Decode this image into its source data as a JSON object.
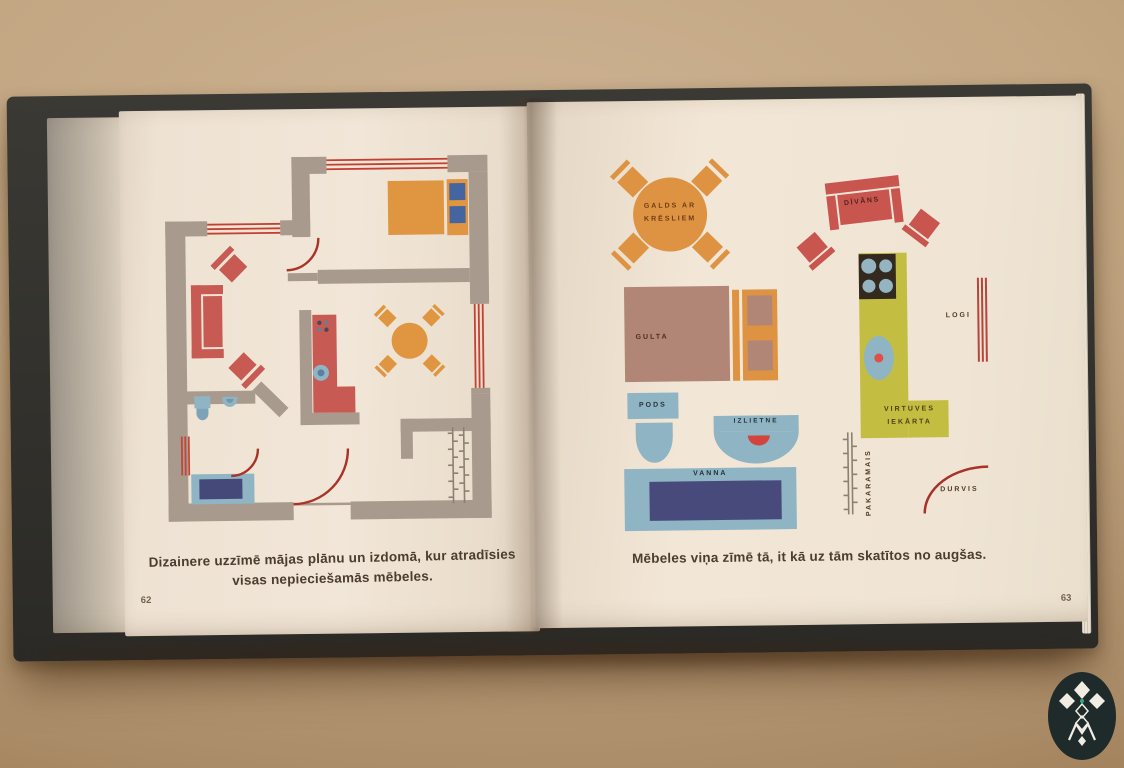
{
  "book": {
    "left_page": {
      "page_number": "62",
      "caption": [
        "Dizainere uzzīmē mājas plānu un izdomā, kur atradīsies",
        "visas nepieciešamās mēbeles."
      ]
    },
    "right_page": {
      "page_number": "63",
      "caption": "Mēbeles viņa zīmē tā, it kā uz tām skatītos no augšas.",
      "labels": {
        "table_line1": "GALDS AR",
        "table_line2": "KRĒSLIEM",
        "sofa": "DĪVĀNS",
        "bed": "GULTA",
        "toilet": "PODS",
        "sink": "IZLIETNE",
        "bath": "VANNA",
        "coat_rack": "PAKARAMAIS",
        "kitchen_line1": "VIRTUVES",
        "kitchen_line2": "IEKĀRTA",
        "windows": "LOGI",
        "door": "DURVIS"
      }
    }
  },
  "colors": {
    "wall_taupe": "#a89b8d",
    "furniture_red": "#c75a52",
    "accent_orange": "#e09540",
    "fixture_blue": "#8fb4c3",
    "tub_navy": "#45497a",
    "kitchen_olive": "#c3be41",
    "bed_mauve": "#b28677",
    "door_arc_red": "#aa3327",
    "pillow_blue": "#44659f",
    "caption_brown": "#4c3d2e",
    "page_cream": "#f0e5d5",
    "cover_black": "#2b2a26",
    "logo_dot_teal": "#2fa987"
  },
  "icons": {
    "logo": "latvian-ornament-logo"
  }
}
